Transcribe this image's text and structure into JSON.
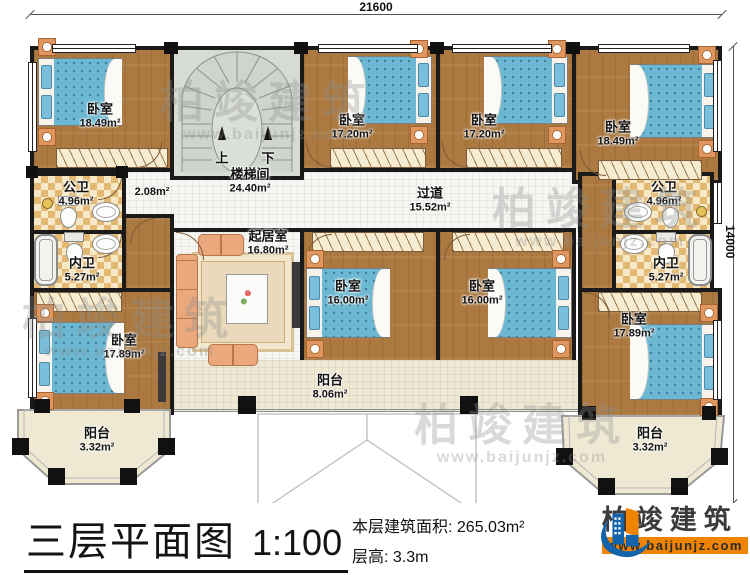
{
  "plan": {
    "dim_top": "21600",
    "dim_right": "14000",
    "small_area": "2.08m²",
    "stair_up": "上",
    "stair_down": "下",
    "rooms": {
      "bedroom_tl": {
        "name": "卧室",
        "area": "18.49m²"
      },
      "stairwell": {
        "name": "楼梯间",
        "area": "24.40m²"
      },
      "bedroom_m1": {
        "name": "卧室",
        "area": "17.20m²"
      },
      "bedroom_m2": {
        "name": "卧室",
        "area": "17.20m²"
      },
      "bedroom_tr": {
        "name": "卧室",
        "area": "18.49m²"
      },
      "bath_public_left": {
        "name": "公卫",
        "area": "4.96m²"
      },
      "bath_private_left": {
        "name": "内卫",
        "area": "5.27m²"
      },
      "bath_public_right": {
        "name": "公卫",
        "area": "4.96m²"
      },
      "bath_private_right": {
        "name": "内卫",
        "area": "5.27m²"
      },
      "hallway": {
        "name": "过道",
        "area": "15.52m²"
      },
      "living": {
        "name": "起居室",
        "area": "16.80m²"
      },
      "bedroom_m3": {
        "name": "卧室",
        "area": "16.00m²"
      },
      "bedroom_m4": {
        "name": "卧室",
        "area": "16.00m²"
      },
      "bedroom_bl": {
        "name": "卧室",
        "area": "17.89m²"
      },
      "bedroom_br": {
        "name": "卧室",
        "area": "17.89m²"
      },
      "balcony_center": {
        "name": "阳台",
        "area": "8.06m²"
      },
      "balcony_bl": {
        "name": "阳台",
        "area": "3.32m²"
      },
      "balcony_br": {
        "name": "阳台",
        "area": "3.32m²"
      }
    },
    "watermark": {
      "text": "柏竣建筑",
      "url": "www.baijunjz.com"
    }
  },
  "footer": {
    "title": "三层平面图",
    "scale": "1:100",
    "area_label": "本层建筑面积:",
    "area_value": "265.03m²",
    "height_label": "层高:",
    "height_value": "3.3m"
  },
  "logo": {
    "name": "柏竣建筑",
    "url": "www.baijunjz.com"
  },
  "colors": {
    "wall": "#1a1a1a",
    "wood_floor": "#ac7a41",
    "bath_tile": "#e3b873",
    "bed_blue": "#6cb8d3",
    "balcony_cream": "#efe9d3",
    "logo_blue": "#1464ac",
    "logo_orange": "#f08300"
  }
}
